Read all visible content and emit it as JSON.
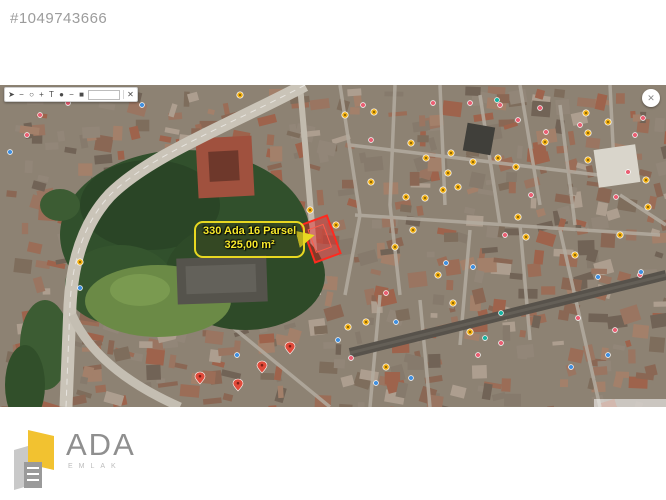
{
  "header": {
    "listing_id": "#1049743666"
  },
  "map": {
    "parcel_label": {
      "line1": "330 Ada 16 Parsel",
      "line2": "325,00 m²"
    },
    "accent_colors": {
      "label_yellow": "#e8d821",
      "parcel_red": "#ff2a1f",
      "marker_yellow": "#f0ae14",
      "marker_pink": "#ea5e72",
      "marker_blue": "#3f8fe0",
      "marker_teal": "#16b3a2",
      "marker_red_pin": "#e04a3a"
    },
    "toolbar": {
      "buttons": [
        {
          "name": "cursor-tool",
          "glyph": "➤"
        },
        {
          "name": "line-tool",
          "glyph": "−"
        },
        {
          "name": "circle-tool",
          "glyph": "○"
        },
        {
          "name": "plus-tool",
          "glyph": "+"
        },
        {
          "name": "text-tool",
          "glyph": "T"
        },
        {
          "name": "color-dot",
          "glyph": "●"
        },
        {
          "name": "minus-tool",
          "glyph": "−"
        },
        {
          "name": "save-tool",
          "glyph": "■"
        },
        {
          "name": "size-box",
          "box": true
        },
        {
          "name": "separator",
          "sep": true
        },
        {
          "name": "close-button",
          "glyph": "✕"
        }
      ]
    },
    "markers": [
      {
        "type": "yellow",
        "x": 374,
        "y": 27
      },
      {
        "type": "yellow",
        "x": 411,
        "y": 58
      },
      {
        "type": "yellow",
        "x": 426,
        "y": 73
      },
      {
        "type": "yellow",
        "x": 451,
        "y": 68
      },
      {
        "type": "yellow",
        "x": 498,
        "y": 73
      },
      {
        "type": "yellow",
        "x": 516,
        "y": 82
      },
      {
        "type": "yellow",
        "x": 473,
        "y": 77
      },
      {
        "type": "yellow",
        "x": 448,
        "y": 88
      },
      {
        "type": "yellow",
        "x": 371,
        "y": 97
      },
      {
        "type": "yellow",
        "x": 425,
        "y": 113
      },
      {
        "type": "yellow",
        "x": 443,
        "y": 105
      },
      {
        "type": "yellow",
        "x": 458,
        "y": 102
      },
      {
        "type": "yellow",
        "x": 406,
        "y": 112
      },
      {
        "type": "yellow",
        "x": 413,
        "y": 145
      },
      {
        "type": "yellow",
        "x": 395,
        "y": 162
      },
      {
        "type": "yellow",
        "x": 518,
        "y": 132
      },
      {
        "type": "yellow",
        "x": 526,
        "y": 152
      },
      {
        "type": "yellow",
        "x": 545,
        "y": 57
      },
      {
        "type": "yellow",
        "x": 586,
        "y": 28
      },
      {
        "type": "yellow",
        "x": 588,
        "y": 48
      },
      {
        "type": "yellow",
        "x": 608,
        "y": 37
      },
      {
        "type": "yellow",
        "x": 588,
        "y": 75
      },
      {
        "type": "yellow",
        "x": 646,
        "y": 95
      },
      {
        "type": "yellow",
        "x": 648,
        "y": 122
      },
      {
        "type": "yellow",
        "x": 438,
        "y": 190
      },
      {
        "type": "yellow",
        "x": 453,
        "y": 218
      },
      {
        "type": "yellow",
        "x": 470,
        "y": 247
      },
      {
        "type": "yellow",
        "x": 348,
        "y": 242
      },
      {
        "type": "yellow",
        "x": 366,
        "y": 237
      },
      {
        "type": "yellow",
        "x": 386,
        "y": 282
      },
      {
        "type": "yellow",
        "x": 80,
        "y": 177
      },
      {
        "type": "yellow",
        "x": 240,
        "y": 10
      },
      {
        "type": "yellow",
        "x": 345,
        "y": 30
      },
      {
        "type": "yellow",
        "x": 310,
        "y": 125
      },
      {
        "type": "yellow",
        "x": 336,
        "y": 140
      },
      {
        "type": "yellow",
        "x": 620,
        "y": 150
      },
      {
        "type": "yellow",
        "x": 575,
        "y": 170
      },
      {
        "type": "pink",
        "x": 363,
        "y": 20
      },
      {
        "type": "pink",
        "x": 433,
        "y": 18
      },
      {
        "type": "pink",
        "x": 470,
        "y": 18
      },
      {
        "type": "pink",
        "x": 500,
        "y": 20
      },
      {
        "type": "pink",
        "x": 540,
        "y": 23
      },
      {
        "type": "pink",
        "x": 518,
        "y": 35
      },
      {
        "type": "pink",
        "x": 546,
        "y": 47
      },
      {
        "type": "pink",
        "x": 580,
        "y": 40
      },
      {
        "type": "pink",
        "x": 643,
        "y": 33
      },
      {
        "type": "pink",
        "x": 635,
        "y": 50
      },
      {
        "type": "pink",
        "x": 371,
        "y": 55
      },
      {
        "type": "pink",
        "x": 531,
        "y": 110
      },
      {
        "type": "pink",
        "x": 628,
        "y": 87
      },
      {
        "type": "pink",
        "x": 616,
        "y": 112
      },
      {
        "type": "pink",
        "x": 351,
        "y": 273
      },
      {
        "type": "pink",
        "x": 386,
        "y": 208
      },
      {
        "type": "pink",
        "x": 501,
        "y": 258
      },
      {
        "type": "pink",
        "x": 478,
        "y": 270
      },
      {
        "type": "pink",
        "x": 578,
        "y": 233
      },
      {
        "type": "pink",
        "x": 615,
        "y": 245
      },
      {
        "type": "pink",
        "x": 640,
        "y": 190
      },
      {
        "type": "pink",
        "x": 27,
        "y": 50
      },
      {
        "type": "pink",
        "x": 40,
        "y": 30
      },
      {
        "type": "pink",
        "x": 68,
        "y": 18
      },
      {
        "type": "pink",
        "x": 505,
        "y": 150
      },
      {
        "type": "blue",
        "x": 446,
        "y": 178
      },
      {
        "type": "blue",
        "x": 473,
        "y": 182
      },
      {
        "type": "blue",
        "x": 396,
        "y": 237
      },
      {
        "type": "blue",
        "x": 411,
        "y": 293
      },
      {
        "type": "blue",
        "x": 376,
        "y": 298
      },
      {
        "type": "blue",
        "x": 641,
        "y": 187
      },
      {
        "type": "blue",
        "x": 598,
        "y": 192
      },
      {
        "type": "blue",
        "x": 571,
        "y": 282
      },
      {
        "type": "blue",
        "x": 10,
        "y": 67
      },
      {
        "type": "blue",
        "x": 80,
        "y": 203
      },
      {
        "type": "blue",
        "x": 142,
        "y": 20
      },
      {
        "type": "blue",
        "x": 237,
        "y": 270
      },
      {
        "type": "blue",
        "x": 338,
        "y": 255
      },
      {
        "type": "blue",
        "x": 608,
        "y": 270
      },
      {
        "type": "teal",
        "x": 501,
        "y": 228
      },
      {
        "type": "teal",
        "x": 485,
        "y": 253
      },
      {
        "type": "teal",
        "x": 497,
        "y": 15
      },
      {
        "type": "red-pin",
        "x": 238,
        "y": 300
      },
      {
        "type": "red-pin",
        "x": 262,
        "y": 282
      },
      {
        "type": "red-pin",
        "x": 290,
        "y": 263
      },
      {
        "type": "red-pin",
        "x": 200,
        "y": 293
      }
    ]
  },
  "logo": {
    "title": "ADA",
    "subtitle": "EMLAK"
  }
}
